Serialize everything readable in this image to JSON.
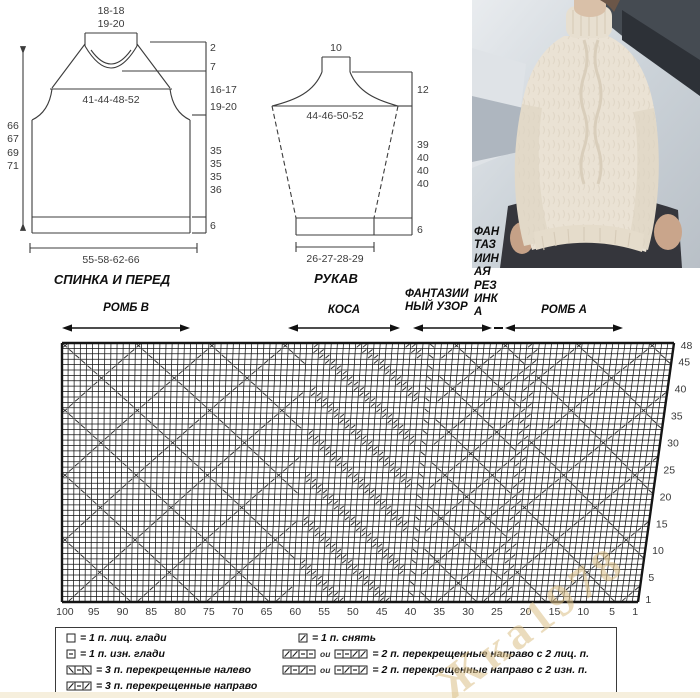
{
  "back": {
    "title": "СПИНКА И ПЕРЕД",
    "neck_width_top": "18-18",
    "neck_width_bottom": "19-20",
    "chest_width": "41-44-48-52",
    "hem_width": "55-58-62-66",
    "lengths_left": [
      "66",
      "67",
      "69",
      "71"
    ],
    "right_marks": [
      "2",
      "7",
      "16-17",
      "19-20",
      "35",
      "35",
      "35",
      "36",
      "6"
    ]
  },
  "sleeve": {
    "title": "РУКАВ",
    "top_width": "10",
    "upper_width": "44-46-50-52",
    "cuff_width": "26-27-28-29",
    "right_marks": [
      "12",
      "39",
      "40",
      "40",
      "40",
      "6"
    ]
  },
  "sections": {
    "romb_b": "РОМБ В",
    "kosa": "КОСА",
    "fantasy_pattern": [
      "ФАНТАЗИИ",
      "НЫЙ УЗОР"
    ],
    "fantasy_rib": [
      "ФАН",
      "ТАЗ",
      "ИИН",
      "АЯ",
      "РЕЗ",
      "ИНК",
      "А"
    ],
    "romb_a": "РОМБ А"
  },
  "chart_data": {
    "type": "knitting-chart",
    "cols": 100,
    "rows": 48,
    "row_ticks": [
      "48",
      "45",
      "40",
      "35",
      "30",
      "25",
      "20",
      "15",
      "10",
      "5",
      "1"
    ],
    "col_ticks": [
      "100",
      "95",
      "90",
      "85",
      "80",
      "75",
      "70",
      "65",
      "60",
      "55",
      "50",
      "45",
      "40",
      "35",
      "30",
      "25",
      "20",
      "15",
      "10",
      "5",
      "1"
    ],
    "sections_left_to_right": [
      "РОМБ В",
      "КОСА",
      "ФАНТАЗИИНЫЙ УЗОР",
      "ФАНТАЗИИНАЯ РЕЗИНКА",
      "РОМБ А"
    ]
  },
  "legend": {
    "left": [
      {
        "text": "= 1 п. лиц. глади"
      },
      {
        "text": "= 1 п. изн. глади"
      },
      {
        "text": "= 3 п. перекрещенные налево"
      },
      {
        "text": "= 3 п. перекрещенные направо"
      }
    ],
    "right": [
      {
        "text": "= 1 п. снять"
      },
      {
        "or": "ou",
        "text": "= 2 п. перекрещенные направо с 2 лиц. п."
      },
      {
        "or": "ou",
        "text": "= 2 п. перекрещенные направо с 2 изн. п."
      }
    ]
  },
  "watermark": "Жка1978"
}
